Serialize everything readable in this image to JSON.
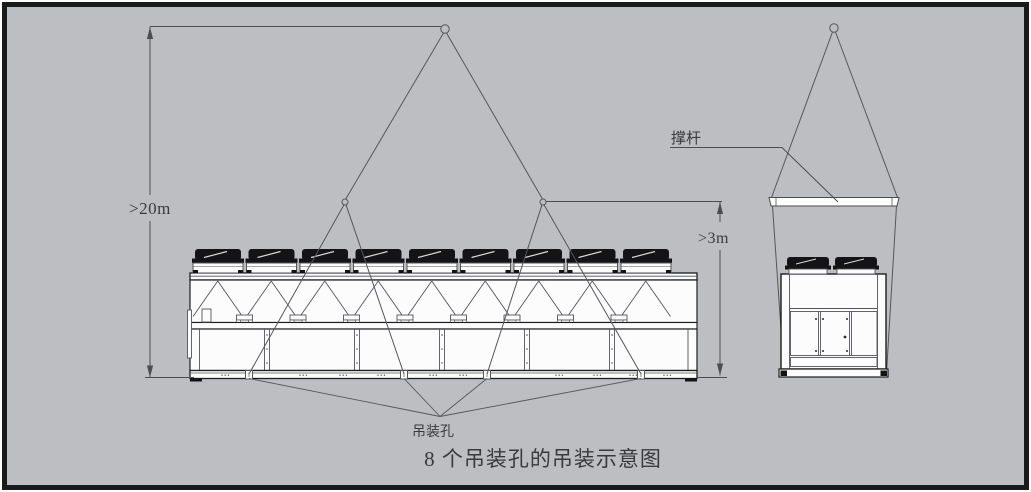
{
  "figure": {
    "caption": "8 个吊装孔的吊装示意图",
    "labels": {
      "lift_height": ">20m",
      "sling_height": ">3m",
      "spreader_bar": "撑杆",
      "lifting_hole": "吊装孔"
    },
    "front_view": {
      "fan_count": 9,
      "visible_lifting_holes": 4,
      "total_lifting_holes": 8,
      "lower_panel_count": 6
    },
    "end_view": {
      "fan_count": 2,
      "door_panel_count": 3
    },
    "colors": {
      "background": "#bdbec2",
      "frame": "#1a1a1c",
      "line": "#53545a",
      "dark": "#141416",
      "panel_fill": "#fcfcfc",
      "text": "#3a3a3e"
    }
  }
}
